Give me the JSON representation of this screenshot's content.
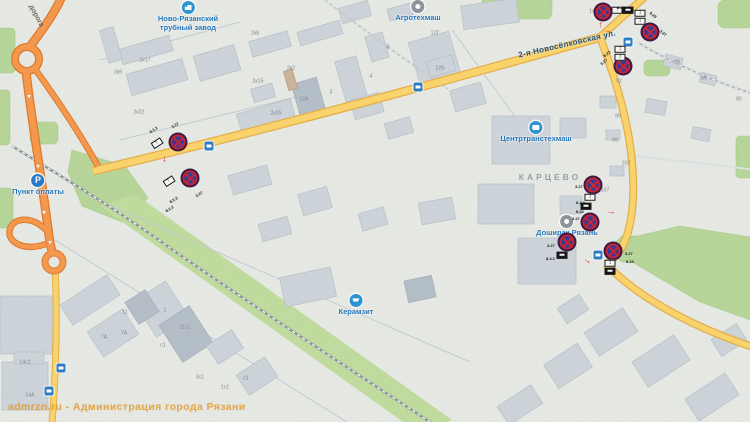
{
  "watermark": {
    "text": "admrzn.ru - Администрация города Рязани"
  },
  "map": {
    "street_labels": [
      {
        "text": "дорога",
        "x": 36,
        "y": 16,
        "rot": 62,
        "cls": "road-name"
      },
      {
        "text": "2-я Новосёлковская ул.",
        "x": 567,
        "y": 44,
        "rot": -13,
        "cls": "street-name"
      },
      {
        "text": "КАРЦЕВО",
        "x": 550,
        "y": 177,
        "rot": 0,
        "cls": "district-name"
      }
    ],
    "pois": [
      {
        "id": "novo-ryazanskiy-trubnyy-zavod",
        "icon": "factory",
        "color": "blue",
        "x": 188,
        "y": 1,
        "lines": [
          "Ново-Рязанский",
          "трубный завод"
        ]
      },
      {
        "id": "agrotekhmash",
        "icon": "dot",
        "color": "gray",
        "x": 418,
        "y": 0,
        "lines": [
          "Агротехмаш"
        ]
      },
      {
        "id": "tsentrtranstekhmash",
        "icon": "bus",
        "color": "blue",
        "x": 536,
        "y": 121,
        "lines": [
          "Центртранстехмаш"
        ]
      },
      {
        "id": "doshirak-ryazan",
        "icon": "dot",
        "color": "gray",
        "x": 567,
        "y": 215,
        "lines": [
          "Доширак Рязань"
        ]
      },
      {
        "id": "keramzit",
        "icon": "cart",
        "color": "blue",
        "x": 356,
        "y": 294,
        "lines": [
          "Керамзит"
        ]
      },
      {
        "id": "punkt-oplaty",
        "icon": "parking",
        "color": "p",
        "x": 38,
        "y": 174,
        "lines": [
          "Пункт оплаты"
        ]
      }
    ],
    "bus_stops": [
      {
        "x": 209,
        "y": 146
      },
      {
        "x": 418,
        "y": 87
      },
      {
        "x": 628,
        "y": 42
      },
      {
        "x": 598,
        "y": 255
      },
      {
        "x": 61,
        "y": 368
      },
      {
        "x": 49,
        "y": 391
      }
    ],
    "signs": [
      {
        "x": 178,
        "y": 142
      },
      {
        "x": 190,
        "y": 178
      },
      {
        "x": 603,
        "y": 12
      },
      {
        "x": 650,
        "y": 32
      },
      {
        "x": 623,
        "y": 66
      },
      {
        "x": 593,
        "y": 185
      },
      {
        "x": 590,
        "y": 222
      },
      {
        "x": 567,
        "y": 242
      },
      {
        "x": 613,
        "y": 251
      }
    ],
    "plates": [
      {
        "x": 157,
        "y": 143,
        "rot": -33,
        "type": "arrow"
      },
      {
        "x": 169,
        "y": 181,
        "rot": -33,
        "type": "arrow"
      },
      {
        "x": 617,
        "y": 10,
        "rot": 0,
        "type": "arrow"
      },
      {
        "x": 628,
        "y": 10,
        "rot": 0,
        "type": "black"
      },
      {
        "x": 640,
        "y": 13,
        "rot": 0,
        "type": "updown"
      },
      {
        "x": 640,
        "y": 21,
        "rot": 0,
        "type": "updown"
      },
      {
        "x": 620,
        "y": 49,
        "rot": 0,
        "type": "updown"
      },
      {
        "x": 620,
        "y": 57,
        "rot": 0,
        "type": "updown"
      },
      {
        "x": 590,
        "y": 197,
        "rot": 0,
        "type": "updown"
      },
      {
        "x": 586,
        "y": 206,
        "rot": 0,
        "type": "black"
      },
      {
        "x": 562,
        "y": 255,
        "rot": 0,
        "type": "black"
      },
      {
        "x": 610,
        "y": 263,
        "rot": 0,
        "type": "updown"
      },
      {
        "x": 610,
        "y": 271,
        "rot": 0,
        "type": "black"
      }
    ],
    "sign_labels": [
      {
        "t": "3.27",
        "x": 172,
        "y": 123,
        "rot": -33
      },
      {
        "t": "8.2.2",
        "x": 150,
        "y": 128,
        "rot": -33
      },
      {
        "t": "3.27",
        "x": 196,
        "y": 192,
        "rot": -33
      },
      {
        "t": "8.2.3",
        "x": 170,
        "y": 198,
        "rot": -33
      },
      {
        "t": "8.2.2",
        "x": 166,
        "y": 207,
        "rot": -33
      },
      {
        "t": "8.23",
        "x": 617,
        "y": 3,
        "rot": 0
      },
      {
        "t": "8.23",
        "x": 650,
        "y": 8,
        "rot": 40
      },
      {
        "t": "3.27",
        "x": 660,
        "y": 26,
        "rot": 40
      },
      {
        "t": "8.23",
        "x": 604,
        "y": 52,
        "rot": -40
      },
      {
        "t": "3.27",
        "x": 601,
        "y": 60,
        "rot": -40
      },
      {
        "t": "3.27",
        "x": 575,
        "y": 182,
        "rot": 0
      },
      {
        "t": "8.2.2",
        "x": 576,
        "y": 198,
        "rot": 0
      },
      {
        "t": "8.24",
        "x": 576,
        "y": 207,
        "rot": 0
      },
      {
        "t": "3.27",
        "x": 572,
        "y": 214,
        "rot": 0
      },
      {
        "t": "3.27",
        "x": 547,
        "y": 241,
        "rot": 0
      },
      {
        "t": "8.4.1",
        "x": 546,
        "y": 254,
        "rot": 0
      },
      {
        "t": "3.27",
        "x": 625,
        "y": 249,
        "rot": 0
      },
      {
        "t": "8.23",
        "x": 626,
        "y": 257,
        "rot": 0
      }
    ],
    "red_arrows": [
      {
        "x": 166,
        "y": 159,
        "rot": 90
      },
      {
        "x": 599,
        "y": 25,
        "rot": -90
      },
      {
        "x": 608,
        "y": 30,
        "rot": 10
      },
      {
        "x": 611,
        "y": 211,
        "rot": 0
      },
      {
        "x": 588,
        "y": 260,
        "rot": 35
      }
    ],
    "road_arrows": [
      {
        "x": 29,
        "y": 97
      },
      {
        "x": 38,
        "y": 167
      },
      {
        "x": 44,
        "y": 213
      },
      {
        "x": 50,
        "y": 243
      }
    ],
    "building_numbers": [
      {
        "t": "2к17",
        "x": 145,
        "y": 60
      },
      {
        "t": "2к9",
        "x": 118,
        "y": 72
      },
      {
        "t": "2к22",
        "x": 139,
        "y": 112
      },
      {
        "t": "2к8",
        "x": 255,
        "y": 33
      },
      {
        "t": "2к2",
        "x": 291,
        "y": 68
      },
      {
        "t": "2к15",
        "x": 258,
        "y": 81
      },
      {
        "t": "2к25",
        "x": 276,
        "y": 113
      },
      {
        "t": "12А",
        "x": 304,
        "y": 99
      },
      {
        "t": "3",
        "x": 331,
        "y": 92
      },
      {
        "t": "4",
        "x": 371,
        "y": 76
      },
      {
        "t": "8",
        "x": 388,
        "y": 47
      },
      {
        "t": "12Г",
        "x": 435,
        "y": 33
      },
      {
        "t": "12Б",
        "x": 440,
        "y": 68
      },
      {
        "t": "14",
        "x": 592,
        "y": 11
      },
      {
        "t": "89",
        "x": 677,
        "y": 62
      },
      {
        "t": "86",
        "x": 704,
        "y": 78
      },
      {
        "t": "80",
        "x": 739,
        "y": 99
      },
      {
        "t": "92",
        "x": 619,
        "y": 81
      },
      {
        "t": "95",
        "x": 618,
        "y": 116
      },
      {
        "t": "99",
        "x": 615,
        "y": 140
      },
      {
        "t": "102",
        "x": 626,
        "y": 163
      },
      {
        "t": "107",
        "x": 605,
        "y": 190
      },
      {
        "t": "11",
        "x": 125,
        "y": 312
      },
      {
        "t": "1",
        "x": 165,
        "y": 310
      },
      {
        "t": "7А",
        "x": 104,
        "y": 337
      },
      {
        "t": "7А",
        "x": 124,
        "y": 333
      },
      {
        "t": "11с1",
        "x": 185,
        "y": 327
      },
      {
        "t": "с1",
        "x": 163,
        "y": 345
      },
      {
        "t": "14с1",
        "x": 25,
        "y": 362
      },
      {
        "t": "14А",
        "x": 30,
        "y": 395
      },
      {
        "t": "3с1",
        "x": 200,
        "y": 377
      },
      {
        "t": "1с1",
        "x": 225,
        "y": 387
      },
      {
        "t": "с1",
        "x": 246,
        "y": 378
      }
    ]
  }
}
